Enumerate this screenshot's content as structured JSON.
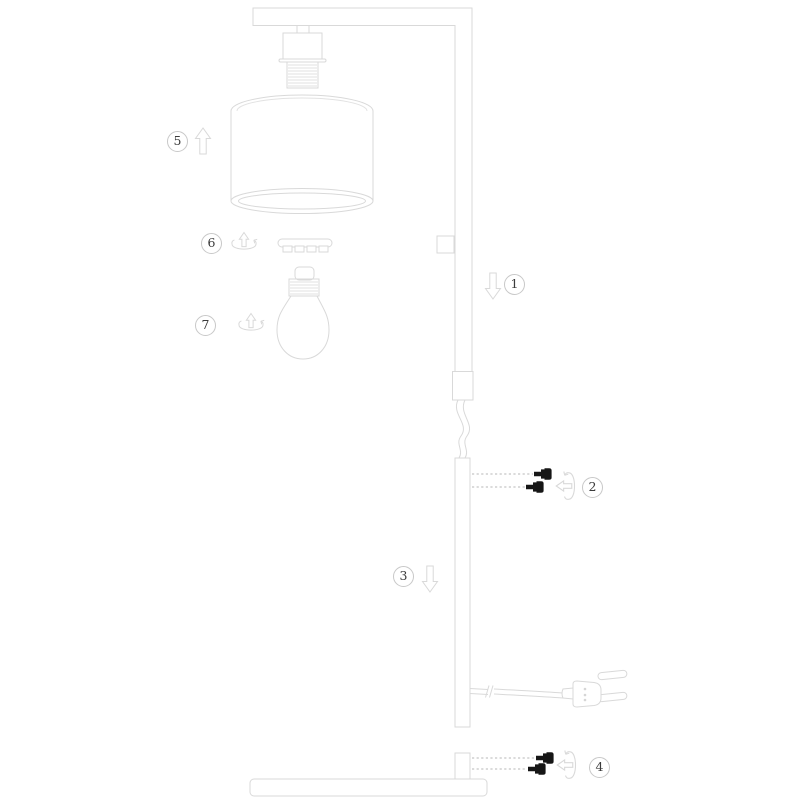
{
  "figure": {
    "kind": "furniture-assembly-diagram",
    "subject": "floor lamp with overhead arm, cylindrical shade and flat base",
    "background_color": "#ffffff",
    "line_color": "#d9d9d9",
    "hatch_color": "#e2e2e2",
    "dashed_guide_color": "#cfcfcf",
    "screw_color": "#161616",
    "callout_border_color": "#c8c8c8",
    "callout_text_color": "#3b3b3b"
  },
  "callouts": [
    {
      "number": "1",
      "icon": "arrow-down-icon"
    },
    {
      "number": "2",
      "icon": "screw-rotate-icon",
      "screw_count": 2
    },
    {
      "number": "3",
      "icon": "arrow-down-icon"
    },
    {
      "number": "4",
      "icon": "screw-rotate-icon",
      "screw_count": 2
    },
    {
      "number": "5",
      "icon": "arrow-up-icon"
    },
    {
      "number": "6",
      "icon": "twist-rotate-icon"
    },
    {
      "number": "7",
      "icon": "twist-rotate-icon"
    }
  ],
  "parts": [
    "overhead-arm-with-upper-pole",
    "lamp-socket",
    "lampshade",
    "shade-retaining-ring",
    "light-bulb",
    "inline-switch-block",
    "pole-connector-sleeve",
    "power-cable-loop",
    "middle-pole",
    "power-cord-with-euro-plug",
    "base-pole-stub",
    "base-plate"
  ]
}
